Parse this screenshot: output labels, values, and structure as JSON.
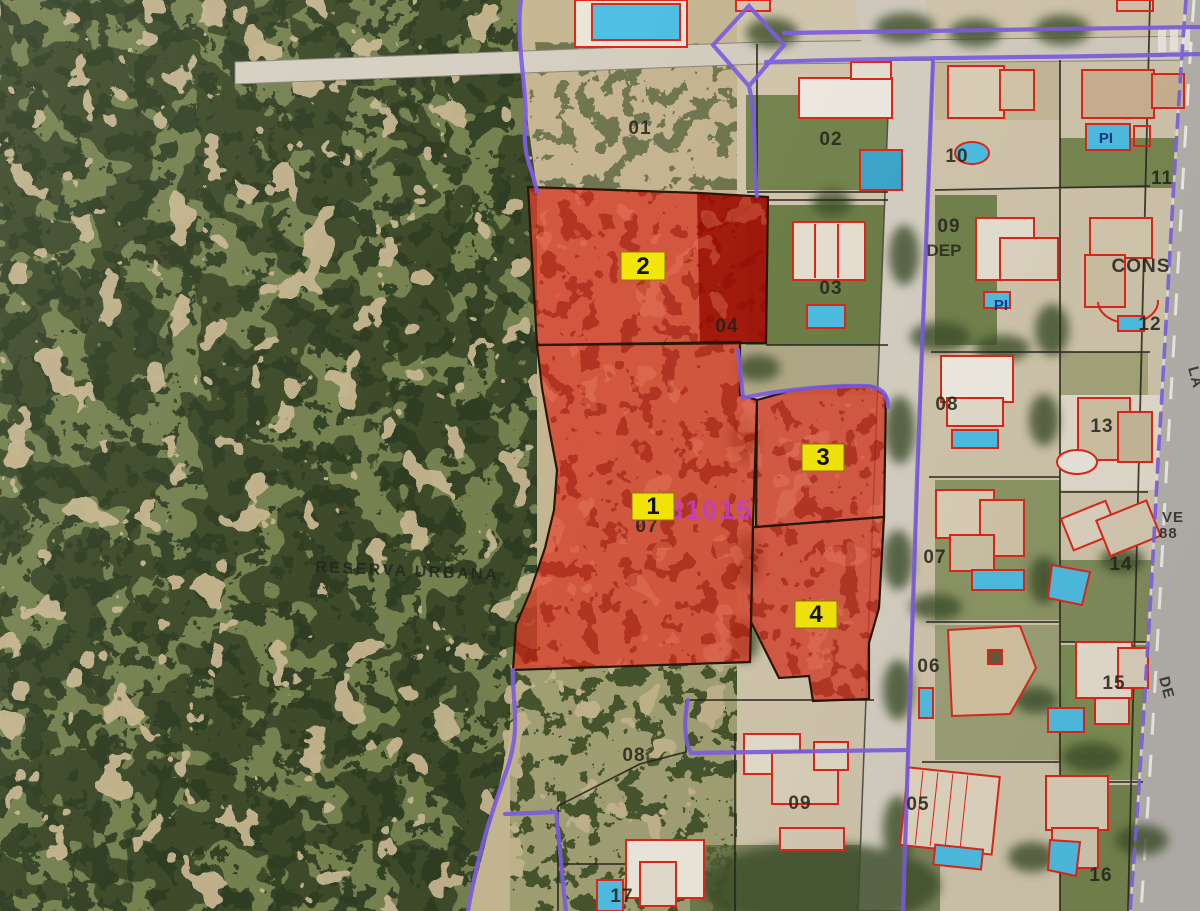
{
  "map": {
    "region_label": "RESERVA URBANA",
    "cadastral_code": "31015",
    "plot_badges": [
      "1",
      "2",
      "3",
      "4"
    ],
    "lot_numbers": [
      "01",
      "02",
      "03",
      "04",
      "07",
      "10",
      "11",
      "09",
      "12",
      "08",
      "13",
      "07",
      "14",
      "06",
      "15",
      "05",
      "16",
      "08",
      "09",
      "17"
    ],
    "annotations": {
      "dep": "DEP",
      "cons": "CONS"
    },
    "pool_labels": [
      "PI",
      "PI"
    ],
    "street_labels": {
      "la": "LA",
      "ve": "VE",
      "num": "88",
      "de": "DE"
    },
    "colors": {
      "boundary_purple": "#7e5fe2",
      "highlight_red": "#d8402a",
      "highlight_red_dark": "#9c1105",
      "building_outline": "#e02818",
      "pool_blue": "#4fc0e4",
      "badge_yellow": "#f6e80a",
      "code_magenta": "#c73fd0"
    }
  }
}
